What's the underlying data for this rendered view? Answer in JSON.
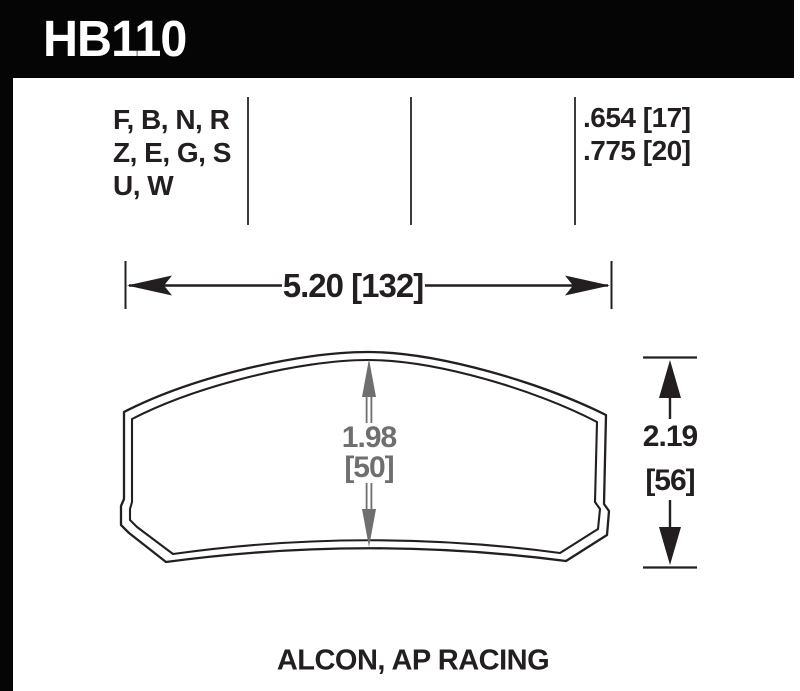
{
  "header": {
    "part_number": "HB110"
  },
  "compound_codes": {
    "lines": [
      "F, B, N, R",
      "Z, E, G, S",
      "U, W"
    ]
  },
  "pad_thickness_options": {
    "lines": [
      ".654 [17]",
      ".775 [20]"
    ]
  },
  "dimensions": {
    "width_label": "5.20 [132]",
    "inner_height_line1": "1.98",
    "inner_height_line2": "[50]",
    "overall_height_line1": "2.19",
    "overall_height_line2": "[56]"
  },
  "footer": {
    "applications": "ALCON, AP RACING"
  },
  "colors": {
    "frame_black": "#050505",
    "ink_black": "#231f20",
    "dimension_gray": "#6f6f6f"
  }
}
